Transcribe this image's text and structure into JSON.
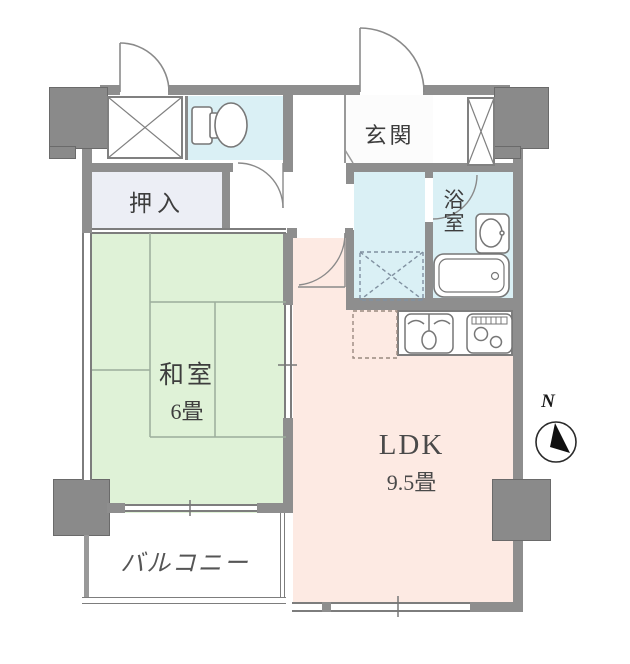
{
  "floor_plan": {
    "rooms": {
      "genkan": {
        "label": "玄関"
      },
      "oshiire": {
        "label": "押入"
      },
      "bathroom": {
        "label_char_1": "浴",
        "label_char_2": "室"
      },
      "washitsu": {
        "label": "和室",
        "size_label": "6畳"
      },
      "ldk": {
        "label": "LDK",
        "size_label": "9.5畳"
      },
      "balcony": {
        "label": "バルコニー"
      }
    },
    "compass": {
      "north_label": "N"
    },
    "fixtures": [
      "toilet-icon",
      "washbasin-icon",
      "bathtub-icon",
      "kitchen-sink-icon",
      "stove-icon",
      "washing-machine-space",
      "refrigerator-space",
      "storage-x-box",
      "shoe-storage-x-box",
      "door-arc",
      "compass-icon"
    ],
    "colors": {
      "wall_gray": "#8e8e8e",
      "wet_area_blue": "#daf0f5",
      "tatami_green": "#dff2d7",
      "ldk_pink": "#fdeae3",
      "closet_lavender": "#eceef5",
      "line_gray": "#777777"
    }
  }
}
